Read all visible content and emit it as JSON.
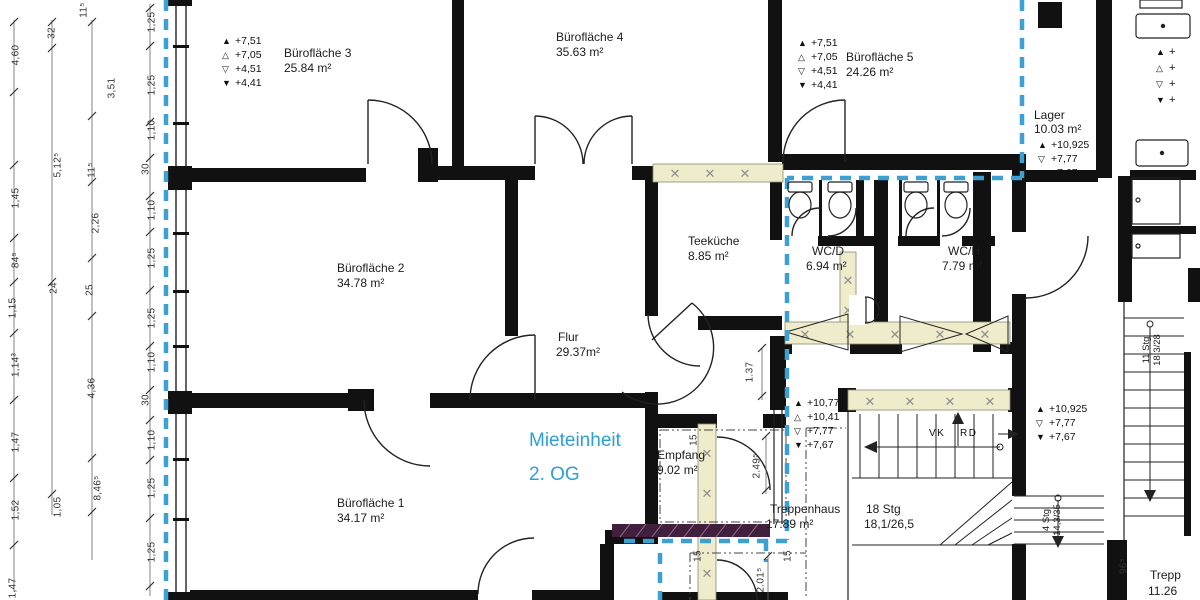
{
  "unit_label": {
    "line1": "Mieteinheit",
    "line2": "2. OG"
  },
  "rooms": {
    "buero1": {
      "name": "Bürofläche 1",
      "area": "34.17 m²"
    },
    "buero2": {
      "name": "Bürofläche 2",
      "area": "34.78 m²"
    },
    "buero3": {
      "name": "Bürofläche 3",
      "area": "25.84 m²"
    },
    "buero4": {
      "name": "Bürofläche 4",
      "area": "35.63 m²"
    },
    "buero5": {
      "name": "Bürofläche 5",
      "area": "24.26 m²"
    },
    "flur": {
      "name": "Flur",
      "area": "29.37m²"
    },
    "teekueche": {
      "name": "Teeküche",
      "area": "8.85 m²"
    },
    "wc_d": {
      "name": "WC/D",
      "area": "6.94 m²"
    },
    "wc_h": {
      "name": "WC/H",
      "area": "7.79 m²"
    },
    "lager": {
      "name": "Lager",
      "area": "10.03 m²"
    },
    "empfang": {
      "name": "Empfang",
      "area": "9.02 m²"
    },
    "treppenhaus": {
      "name": "Treppenhaus",
      "area": "17.89 m²"
    },
    "treppe_cut": {
      "name": "Trepp",
      "area": "11.26"
    }
  },
  "level_markers": {
    "buero3": [
      {
        "sym": "▲",
        "val": "+7,51"
      },
      {
        "sym": "△",
        "val": "+7,05"
      },
      {
        "sym": "▽",
        "val": "+4,51"
      },
      {
        "sym": "▼",
        "val": "+4,41"
      }
    ],
    "buero5": [
      {
        "sym": "▲",
        "val": "+7,51"
      },
      {
        "sym": "△",
        "val": "+7,05"
      },
      {
        "sym": "▽",
        "val": "+4,51"
      },
      {
        "sym": "▼",
        "val": "+4,41"
      }
    ],
    "lager": [
      {
        "sym": "▲",
        "val": "+10,925"
      },
      {
        "sym": "▽",
        "val": "+7,77"
      },
      {
        "sym": "▼",
        "val": "+7,67"
      }
    ],
    "stair_mid": [
      {
        "sym": "▲",
        "val": "+10,77"
      },
      {
        "sym": "△",
        "val": "+10,41"
      },
      {
        "sym": "▽",
        "val": "+7,77"
      },
      {
        "sym": "▼",
        "val": "+7,67"
      }
    ],
    "corridor_right": [
      {
        "sym": "▲",
        "val": "+10,925"
      },
      {
        "sym": "▽",
        "val": "+7,77"
      },
      {
        "sym": "▼",
        "val": "+7,67"
      }
    ],
    "right_edge": [
      {
        "sym": "▲",
        "val": "+"
      },
      {
        "sym": "△",
        "val": "+"
      },
      {
        "sym": "▽",
        "val": "+"
      },
      {
        "sym": "▼",
        "val": "+"
      }
    ]
  },
  "stairs": {
    "main": {
      "steps": "18 Stg",
      "ratio": "18,1/26,5"
    },
    "side": {
      "steps": "4 Stg",
      "ratio": "14,3/35"
    },
    "neighbor": {
      "steps": "11 Stg",
      "ratio": "18,3/28"
    }
  },
  "annotations": {
    "vk": "VK",
    "rd": "RD"
  },
  "dimensions": [
    {
      "t": "4,60",
      "x": 16,
      "y": 55
    },
    {
      "t": "1,45",
      "x": 16,
      "y": 198
    },
    {
      "t": "84⁵",
      "x": 16,
      "y": 260
    },
    {
      "t": "1,15",
      "x": 13,
      "y": 308
    },
    {
      "t": "1,14³",
      "x": 16,
      "y": 365
    },
    {
      "t": "1,47",
      "x": 16,
      "y": 442
    },
    {
      "t": "1,52",
      "x": 16,
      "y": 510
    },
    {
      "t": "1,47",
      "x": 13,
      "y": 588
    },
    {
      "t": "32",
      "x": 52,
      "y": 33
    },
    {
      "t": "5,12⁵",
      "x": 58,
      "y": 165
    },
    {
      "t": "24",
      "x": 54,
      "y": 288
    },
    {
      "t": "1,05",
      "x": 58,
      "y": 507
    },
    {
      "t": "11⁵",
      "x": 84,
      "y": 10
    },
    {
      "t": "3,51",
      "x": 112,
      "y": 88
    },
    {
      "t": "11⁵",
      "x": 92,
      "y": 170
    },
    {
      "t": "2,26",
      "x": 96,
      "y": 223
    },
    {
      "t": "25",
      "x": 90,
      "y": 290
    },
    {
      "t": "4,36",
      "x": 92,
      "y": 388
    },
    {
      "t": "8,46⁵",
      "x": 98,
      "y": 488
    },
    {
      "t": "1,25",
      "x": 152,
      "y": 22
    },
    {
      "t": "1,25",
      "x": 152,
      "y": 85
    },
    {
      "t": "1,10",
      "x": 152,
      "y": 130
    },
    {
      "t": "30",
      "x": 146,
      "y": 169
    },
    {
      "t": "1,10",
      "x": 152,
      "y": 210
    },
    {
      "t": "1,25",
      "x": 152,
      "y": 258
    },
    {
      "t": "1,25",
      "x": 152,
      "y": 318
    },
    {
      "t": "1,10",
      "x": 152,
      "y": 362
    },
    {
      "t": "30",
      "x": 146,
      "y": 400
    },
    {
      "t": "1,10",
      "x": 152,
      "y": 440
    },
    {
      "t": "1,25",
      "x": 152,
      "y": 488
    },
    {
      "t": "1,25",
      "x": 152,
      "y": 552
    },
    {
      "t": "1.37",
      "x": 750,
      "y": 372
    },
    {
      "t": "2.49⁵",
      "x": 757,
      "y": 466
    },
    {
      "t": "2.01⁵",
      "x": 761,
      "y": 580
    },
    {
      "t": "96⁵",
      "x": 1124,
      "y": 566
    },
    {
      "t": "15",
      "x": 694,
      "y": 440
    },
    {
      "t": "15",
      "x": 698,
      "y": 556
    },
    {
      "t": "15",
      "x": 788,
      "y": 556
    }
  ],
  "colors": {
    "unit_boundary": "#3da0d2",
    "unit_text": "#2e9fd6",
    "wall": "#111111",
    "hatch_fill": "#eeeccb",
    "demolition_fill": "#40203c"
  }
}
